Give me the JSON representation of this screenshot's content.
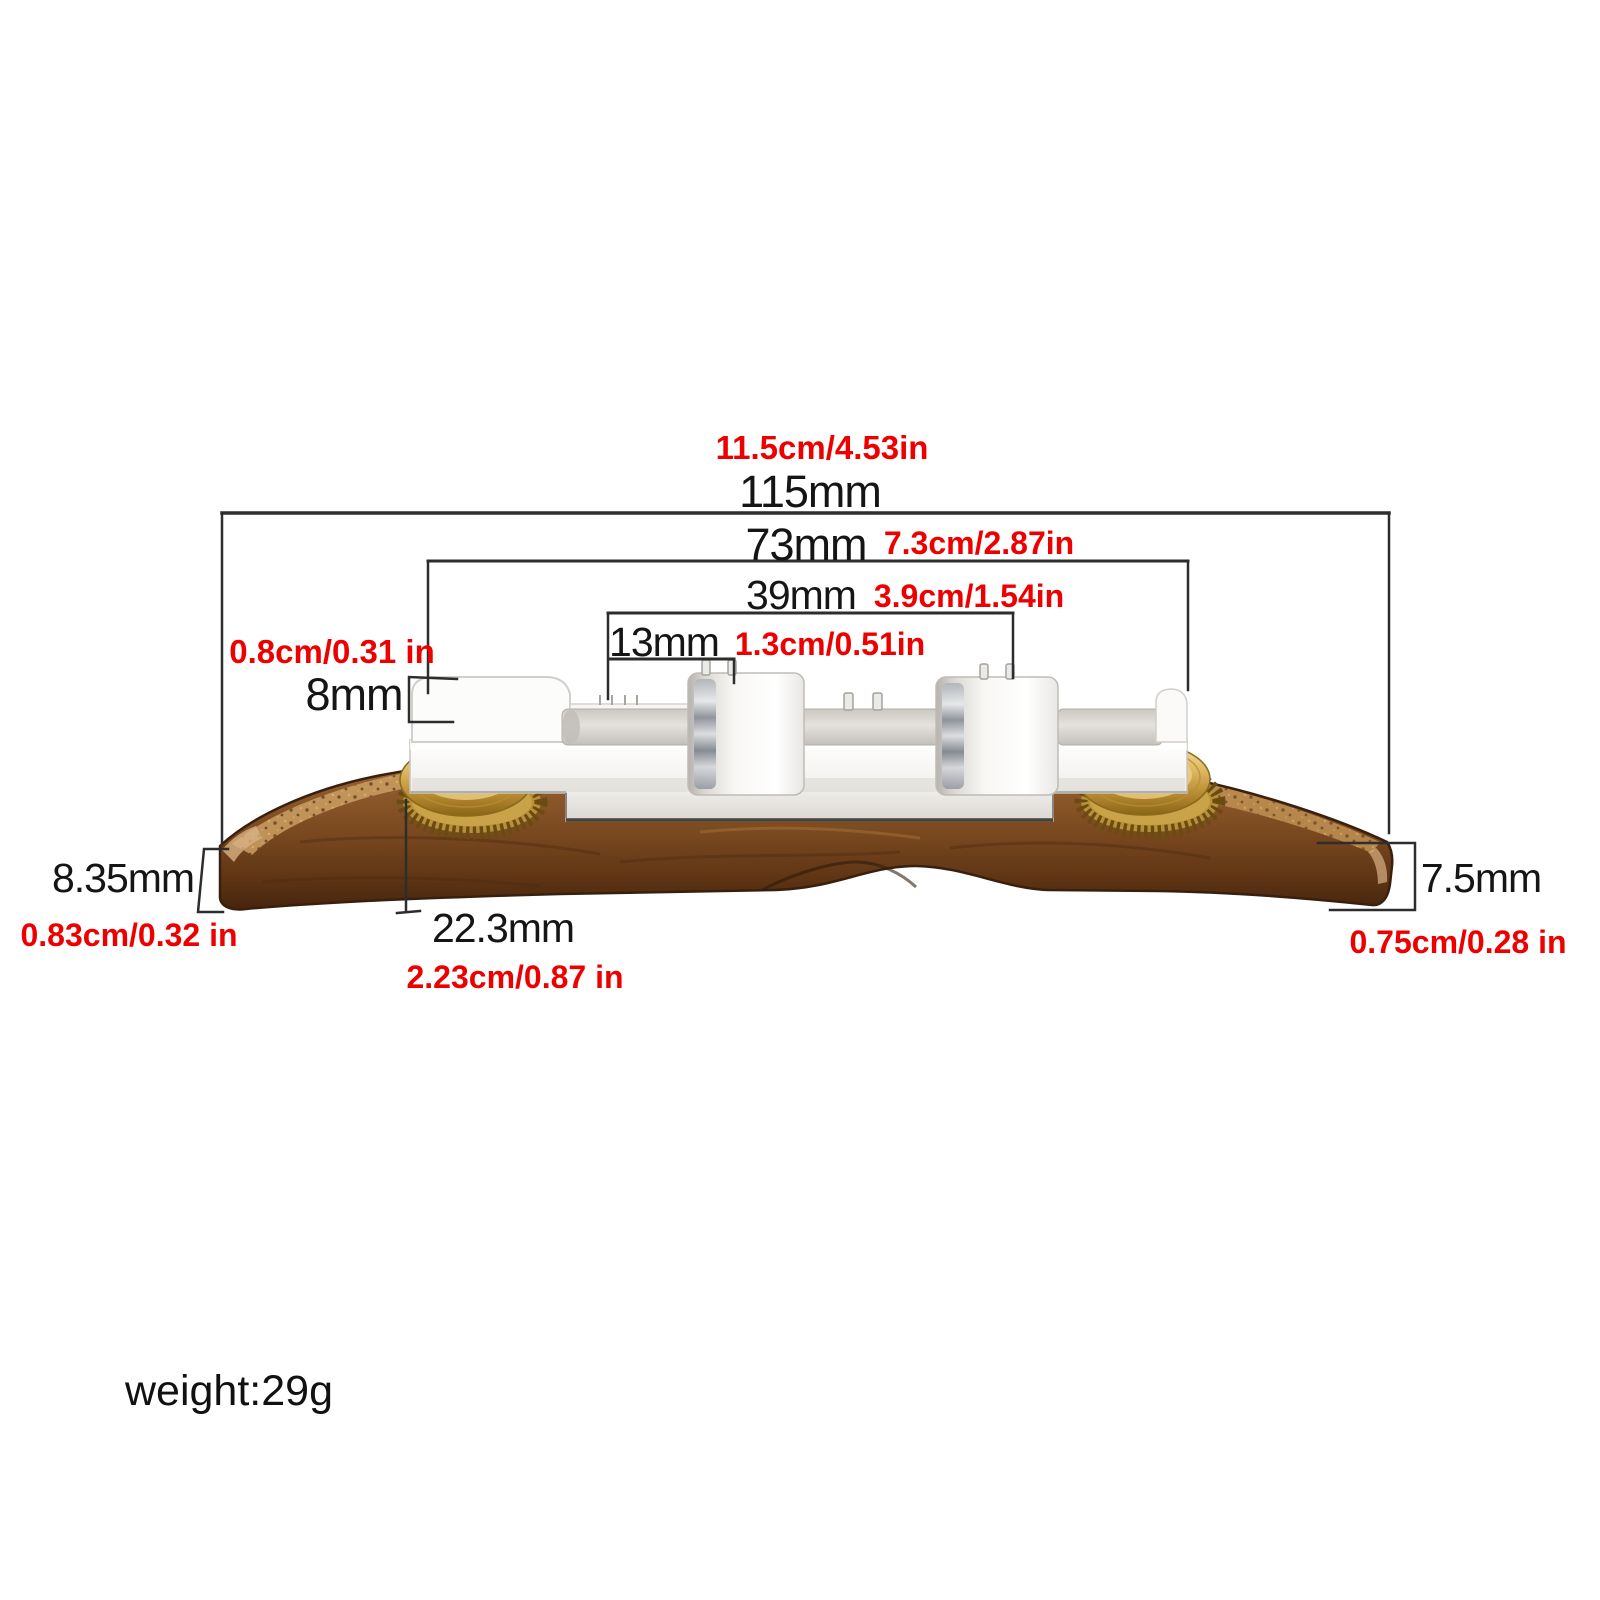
{
  "title": "adjustable bridge size diagram",
  "dims": {
    "d115": {
      "mm": "115mm",
      "cm": "11.5cm/4.53in"
    },
    "d73": {
      "mm": "73mm",
      "cm": "7.3cm/2.87in"
    },
    "d39": {
      "mm": "39mm",
      "cm": "3.9cm/1.54in"
    },
    "d13": {
      "mm": "13mm",
      "cm": "1.3cm/0.51in"
    },
    "d8": {
      "mm": "8mm",
      "cm": "0.8cm/0.31 in"
    },
    "d835": {
      "mm": "8.35mm",
      "cm": "0.83cm/0.32 in"
    },
    "d223": {
      "mm": "22.3mm",
      "cm": "2.23cm/0.87 in"
    },
    "d75": {
      "mm": "7.5mm",
      "cm": "0.75cm/0.28 in"
    }
  },
  "weight": {
    "label": "weight:29g"
  },
  "colors": {
    "background": "#ffffff",
    "annotation_black": "#151515",
    "annotation_red": "#ee0000",
    "dimension_line": "#2d2d2d",
    "wood_brown": "#7d4c22",
    "wood_dark_edge": "#39200e",
    "wood_highlight": "#c89a5e",
    "brass_gold": "#c89a3a",
    "metal_silver": "#f2f1ef"
  }
}
